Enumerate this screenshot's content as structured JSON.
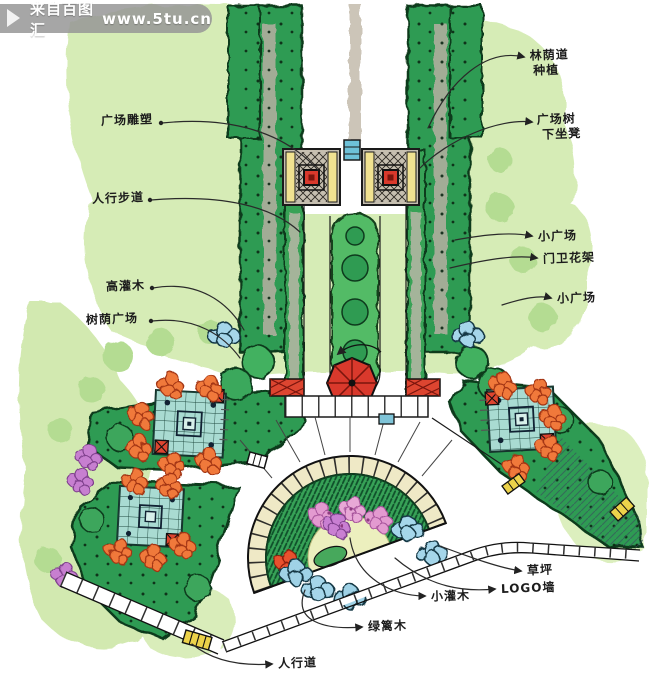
{
  "watermark": {
    "site_name": "来自百图汇",
    "site_url": "www.5tu.cn"
  },
  "annotations": {
    "avenue_planting_line1": "林荫道",
    "avenue_planting_line2": "种植",
    "plaza_tree_line1": "广场树",
    "plaza_tree_line2": "下坐凳",
    "small_plaza_upper": "小广场",
    "gate_trellis": "门卫花架",
    "small_plaza_lower": "小广场",
    "lawn": "草坪",
    "logo_wall": "LOGO墙",
    "small_shrub": "小灌木",
    "hedge": "绿篱木",
    "footpath": "人行道",
    "plaza_sculpture": "广场雕塑",
    "pedestrian_walkway": "人行步道",
    "tall_shrub": "高灌木",
    "shaded_plaza": "树荫广场"
  },
  "palette": {
    "ink": "#1a1a1a",
    "tree_dark": "#2f9b52",
    "tree_mid": "#43b161",
    "wash_green": "#d6ecb6",
    "paving_gray": "#c6bfb0",
    "accent_red": "#d9392c",
    "teal_plaza": "#a9dbd2",
    "flower_orange": "#f0793a",
    "flower_pink": "#e39ad0",
    "flower_purple": "#c77fd0",
    "shrub_blue": "#a5d6ea",
    "bench_yellow": "#ecd24a",
    "band_yellow": "#f1e291",
    "watermark_gray": "#969696"
  }
}
